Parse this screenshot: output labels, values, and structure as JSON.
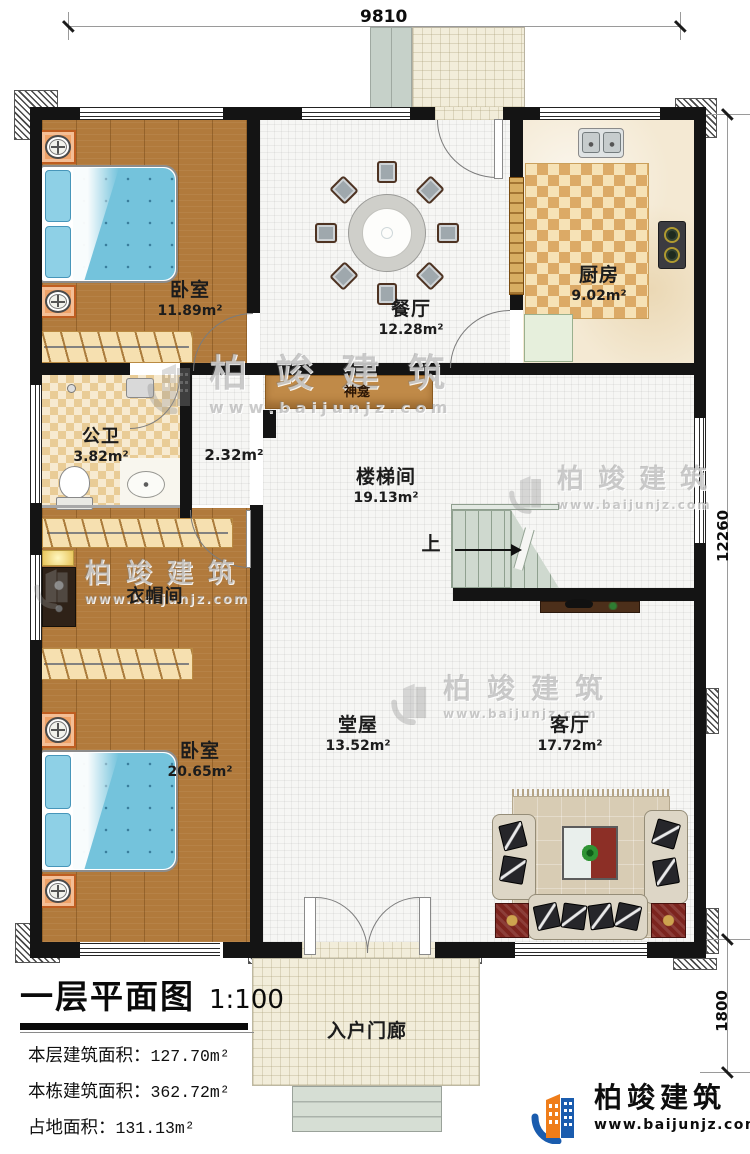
{
  "dimensions": {
    "top": "9810",
    "right_main": "12260",
    "right_porch": "1800"
  },
  "rooms": {
    "bedroom1": {
      "name": "卧室",
      "area": "11.89m²"
    },
    "dining": {
      "name": "餐厅",
      "area": "12.28m²"
    },
    "kitchen": {
      "name": "厨房",
      "area": "9.02m²"
    },
    "bathroom": {
      "name": "公卫",
      "area": "3.82m²"
    },
    "shrine": {
      "name": "神龛",
      "area": "2.32m²"
    },
    "stairwell": {
      "name": "楼梯间",
      "area": "19.13m²"
    },
    "cloakroom": {
      "name": "衣帽间"
    },
    "bedroom2": {
      "name": "卧室",
      "area": "20.65m²"
    },
    "hall": {
      "name": "堂屋",
      "area": "13.52m²"
    },
    "living": {
      "name": "客厅",
      "area": "17.72m²"
    },
    "entry_porch": {
      "name": "入户门廊"
    }
  },
  "stairs": {
    "up_label": "上"
  },
  "info_panel": {
    "title": "一层平面图",
    "scale": "1:100",
    "rows": [
      {
        "label": "本层建筑面积：",
        "value": "127.70m²"
      },
      {
        "label": "本栋建筑面积：",
        "value": "362.72m²"
      },
      {
        "label": "占地面积：",
        "value": "131.13m²"
      },
      {
        "label": "层高：",
        "value": "3.6m"
      }
    ]
  },
  "branding": {
    "company": "柏竣建筑",
    "website": "www.baijunjz.com"
  },
  "colors": {
    "wall": "#141414",
    "wood": "#b17a3c",
    "accent_orange": "#ef7d1a",
    "accent_blue": "#1a5cae"
  }
}
